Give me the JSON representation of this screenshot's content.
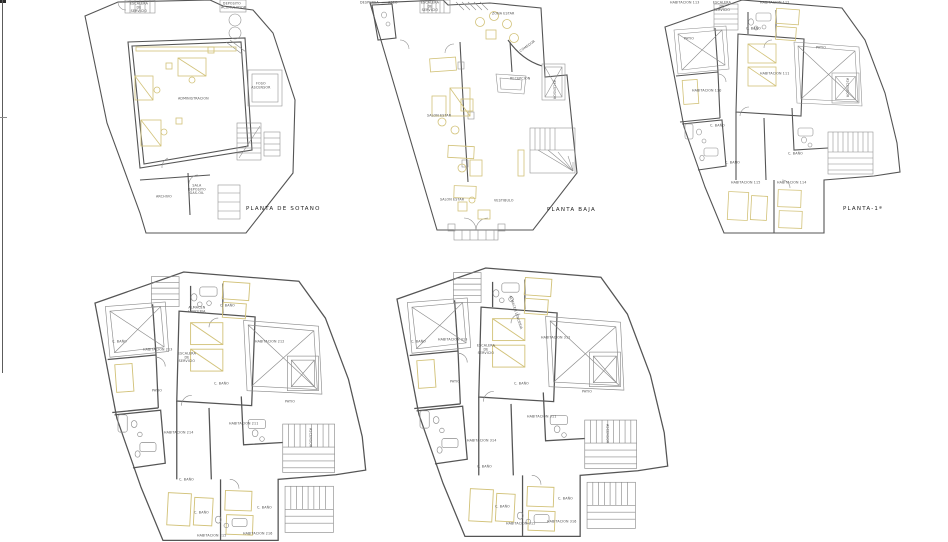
{
  "sheet": {
    "kind": "architectural floor plans",
    "line_color": "#6a6a6a",
    "wall_color": "#555555",
    "furniture_color": "#d2c279",
    "text_color": "#4f4f4f",
    "background": "#ffffff"
  },
  "plans": {
    "sotano": {
      "title": "PLANTA DE SOTANO",
      "labels": {
        "escalera_servicio": "ESCALERA DE SERVICIO",
        "deposito_acumulador": "DEPOSITO ACUMULADOR",
        "foso_ascensor": "FOSO ASCENSOR",
        "administracion": "ADMINISTRACION",
        "archivo": "ARCHIVO",
        "sala_deposito": "SALA DEPOSITO GAS-OIL"
      }
    },
    "baja": {
      "title": "PLANTA BAJA",
      "labels": {
        "despensa": "DESPENSA",
        "aseo": "ASEO",
        "escalera_servicio": "ESCALERA DE SERVICIO",
        "zona_estar": "ZONA ESTAR",
        "comedor": "COMEDOR",
        "recepcion": "RECEPCION",
        "ascensor": "ASCENSOR",
        "salon_estar_1": "SALON ESTAR",
        "salon_estar_2": "SALON ESTAR",
        "vestibulo": "VESTIBULO"
      }
    },
    "primera": {
      "title": "PLANTA-1ª",
      "labels": {
        "hab_113": "HABITACION 113",
        "escalera_servicio": "ESCALERA DE SERVICIO",
        "hab_112": "HABITACION 112",
        "patio_izq": "PATIO",
        "bano_1": "C. BAÑO",
        "hab_111": "HABITACION 111",
        "patio_der": "PATIO",
        "ascensor": "ASCENSOR",
        "hab_110": "HABITACION 110",
        "bano_2": "C. BAÑO",
        "bano_3": "C. BAÑO",
        "bano_4": "C. BAÑO",
        "hab_115": "HABITACION 115",
        "hab_114": "HABITACION 114"
      }
    },
    "segunda": {
      "labels": {
        "bano_1": "C. BAÑO",
        "hab_213": "HABITACION 213",
        "almacen_lenceria": "ALMACEN LENCERIA",
        "escalera_servicio": "ESCALERA DE SERVICIO",
        "bano_2": "C. BAÑO",
        "hab_212": "HABITACION 212",
        "patio_izq": "PATIO",
        "bano_3": "C. BAÑO",
        "hab_214": "HABITACION 214",
        "hab_211": "HABITACION 211",
        "patio_der": "PATIO",
        "ascensor": "ASCENSOR",
        "bano_4": "C. BAÑO",
        "bano_5": "C. BAÑO",
        "bano_6": "C. BAÑO",
        "hab_215": "HABITACION 215",
        "hab_216": "HABITACION 216"
      }
    },
    "tercera": {
      "labels": {
        "bano_1": "C. BAÑO",
        "hab_313": "HABITACION 313",
        "almacen_lenceria": "ALMACEN LENCERIA",
        "escalera_servicio": "ESCALERA DE SERVICIO",
        "hab_312": "HABITACION 312",
        "patio_izq": "PATIO",
        "bano_2": "C. BAÑO",
        "hab_314": "HABITACION 314",
        "hab_311": "HABITACION 311",
        "patio_der": "PATIO",
        "ascensor": "ASCENSOR",
        "bano_3": "C. BAÑO",
        "bano_4": "C. BAÑO",
        "bano_5": "C. BAÑO",
        "hab_315": "HABITACION 315",
        "hab_316": "HABITACION 316"
      }
    }
  }
}
